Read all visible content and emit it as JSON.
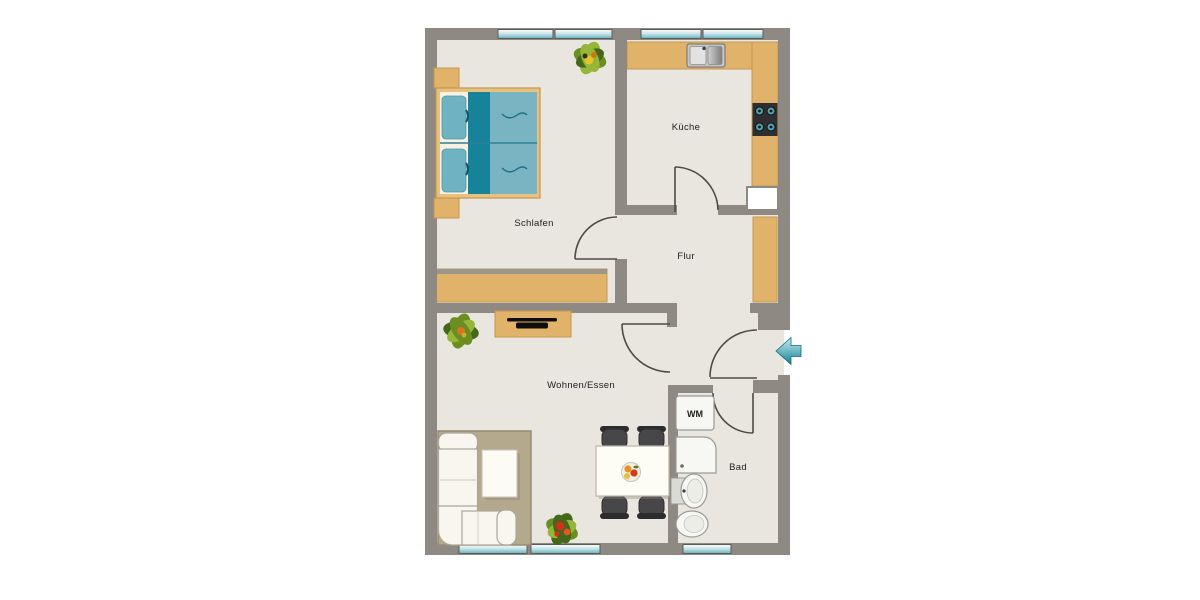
{
  "page": {
    "type": "floor-plan",
    "background": "#ffffff"
  },
  "rooms": {
    "schlafen": {
      "label": "Schlafen"
    },
    "kueche": {
      "label": "Küche"
    },
    "flur": {
      "label": "Flur"
    },
    "wohnen": {
      "label": "Wohnen/Essen"
    },
    "bad": {
      "label": "Bad"
    }
  },
  "appliances": {
    "washing_machine_label": "WM"
  },
  "entrance": {
    "arrow_direction": "left"
  },
  "furniture_icons": [
    "double-bed",
    "nightstand",
    "wardrobe",
    "kitchen-counter",
    "kitchen-sink",
    "stove",
    "fridge",
    "hall-wardrobe",
    "sideboard",
    "tv",
    "plant",
    "rug",
    "corner-sofa",
    "coffee-table",
    "dining-table",
    "chair",
    "fruit-bowl",
    "washing-machine",
    "shower",
    "bath-sink",
    "toilet",
    "window",
    "door-arc"
  ],
  "colors": {
    "wall": "#8E8A83",
    "floor": "#E9E6DF",
    "wood": "#E0B26A",
    "wood_border": "#C49750",
    "window_teal": "#62B4C2",
    "bed_dark": "#17839B",
    "bed_light": "#7AB4C2",
    "pillow": "#6FB3C2",
    "rug": "#B4A88D",
    "rug_border": "#978C71",
    "sofa": "#F8F6EF",
    "sofa_border": "#ABA79B",
    "chair": "#47474A",
    "chair_dark": "#2C2C2E",
    "fixture": "#F7F7F4",
    "fixture_border": "#9A9A96",
    "door": "#4E4A44",
    "label": "#1E1E1E",
    "arrow_dark": "#128196"
  }
}
